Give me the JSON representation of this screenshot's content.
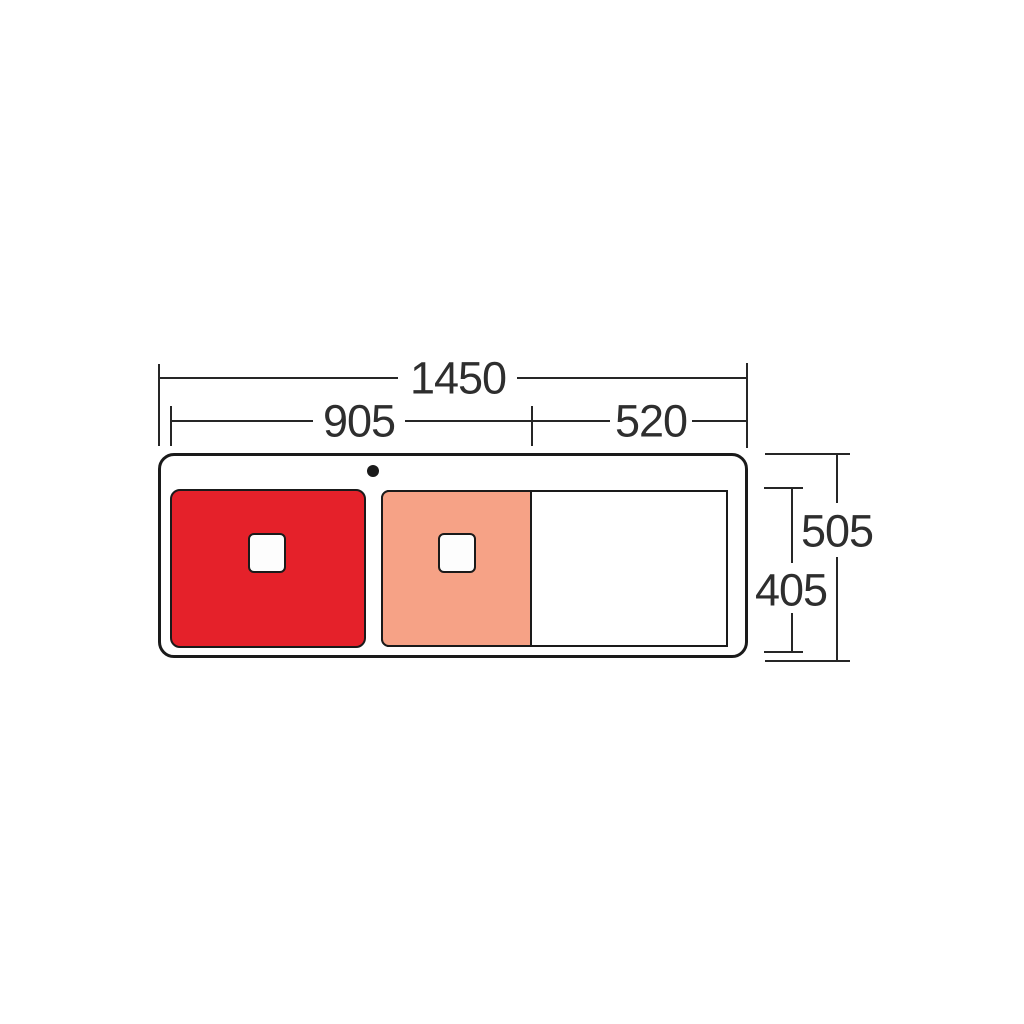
{
  "diagram": {
    "type": "sink-technical-dimension-drawing",
    "labels": {
      "overall_width": "1450",
      "bowls_width": "905",
      "drainer_width": "520",
      "overall_depth": "505",
      "bowl_depth": "405"
    },
    "colors": {
      "main_bowl": "#e5212a",
      "half_bowl": "#f6a286",
      "drainer": "#ffffff",
      "line": "#262626",
      "outline": "#1a1a1a"
    }
  }
}
